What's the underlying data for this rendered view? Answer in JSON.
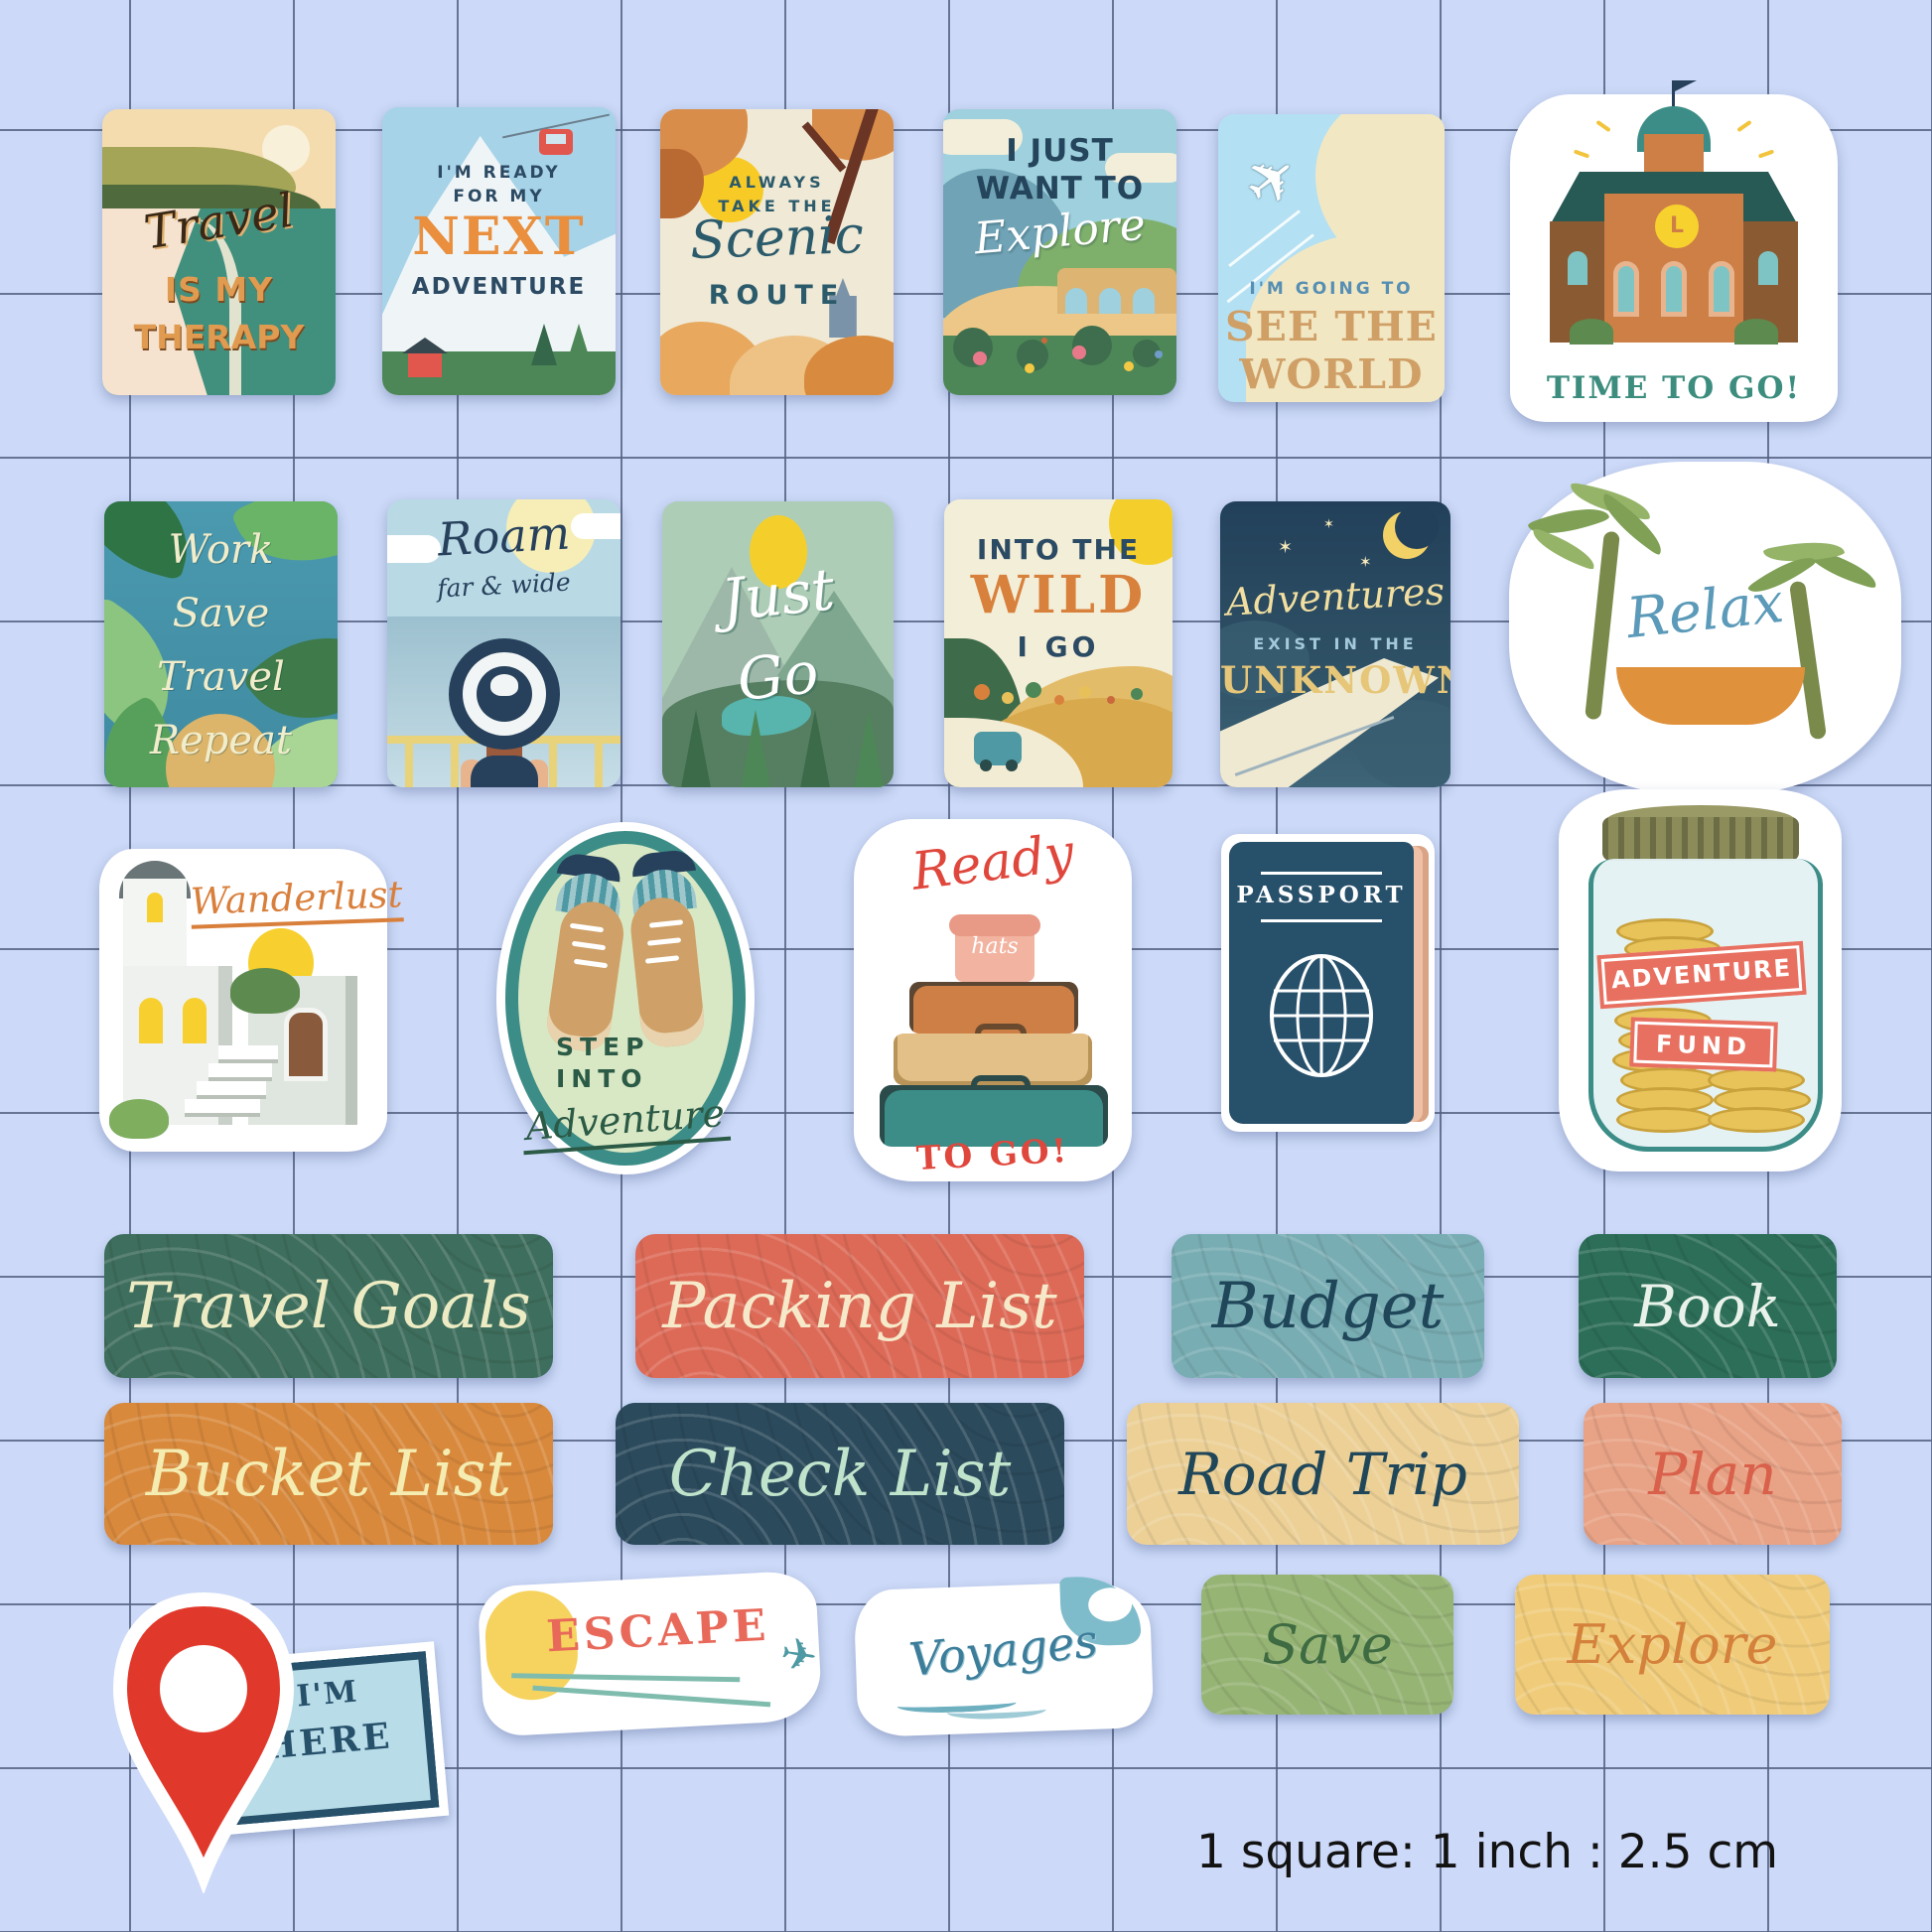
{
  "background": {
    "page_bg": "#CCD9F8",
    "grid_line": "#566382"
  },
  "scale_note": "1 square: 1 inch : 2.5 cm",
  "stickers": {
    "travel_therapy": {
      "script": "Travel",
      "line2": "IS MY",
      "line3": "THERAPY"
    },
    "next_adventure": {
      "pre1": "I'M READY",
      "pre2": "FOR MY",
      "big": "NEXT",
      "last": "ADVENTURE"
    },
    "scenic_route": {
      "pre1": "ALWAYS",
      "pre2": "TAKE THE",
      "script": "Scenic",
      "last": "ROUTE"
    },
    "explore_card": {
      "line1": "I JUST",
      "line2": "WANT TO",
      "script": "Explore"
    },
    "see_world": {
      "pre": "I'M GOING TO",
      "line1": "SEE THE",
      "line2": "WORLD"
    },
    "time_to_go": {
      "caption": "TIME TO GO!",
      "clock_letter": "L"
    },
    "work_save": {
      "lines": [
        "Work",
        "Save",
        "Travel",
        "Repeat"
      ]
    },
    "roam": {
      "script": "Roam",
      "sub": "far & wide"
    },
    "just_go": {
      "line1": "Just",
      "line2": "Go"
    },
    "into_wild": {
      "line1": "INTO THE",
      "big": "WILD",
      "line2": "I GO"
    },
    "adventures_unknown": {
      "script": "Adventures",
      "mid": "EXIST IN THE",
      "big": "UNKNOWN"
    },
    "relax": {
      "script": "Relax"
    },
    "wanderlust": {
      "script": "Wanderlust"
    },
    "step_adventure": {
      "line1": "STEP",
      "line2": "INTO",
      "script": "Adventure"
    },
    "ready_to_go": {
      "script": "Ready",
      "hatbox": "hats",
      "caption": "TO GO!"
    },
    "passport": {
      "title": "PASSPORT"
    },
    "adventure_fund": {
      "line1": "ADVENTURE",
      "line2": "FUND"
    },
    "im_here": {
      "line1": "I'M",
      "line2": "HERE"
    },
    "escape": {
      "caption": "ESCAPE"
    },
    "voyages": {
      "script": "Voyages"
    }
  },
  "labels": [
    {
      "text": "Travel Goals",
      "bg": "#3E6E5D",
      "fg": "#ECEBC3"
    },
    {
      "text": "Packing List",
      "bg": "#DD6A57",
      "fg": "#F6E9C9"
    },
    {
      "text": "Budget",
      "bg": "#78ADB3",
      "fg": "#1F4659"
    },
    {
      "text": "Book",
      "bg": "#2C6E58",
      "fg": "#E8F2EA"
    },
    {
      "text": "Bucket List",
      "bg": "#D8893C",
      "fg": "#F4ECB0"
    },
    {
      "text": "Check List",
      "bg": "#2B4A5C",
      "fg": "#BFE3CB"
    },
    {
      "text": "Road Trip",
      "bg": "#ECD096",
      "fg": "#1F4659"
    },
    {
      "text": "Plan",
      "bg": "#E8A285",
      "fg": "#D9604A"
    },
    {
      "text": "Save",
      "bg": "#96B474",
      "fg": "#3E6B42"
    },
    {
      "text": "Explore",
      "bg": "#F0CC7A",
      "fg": "#D4813C"
    }
  ]
}
